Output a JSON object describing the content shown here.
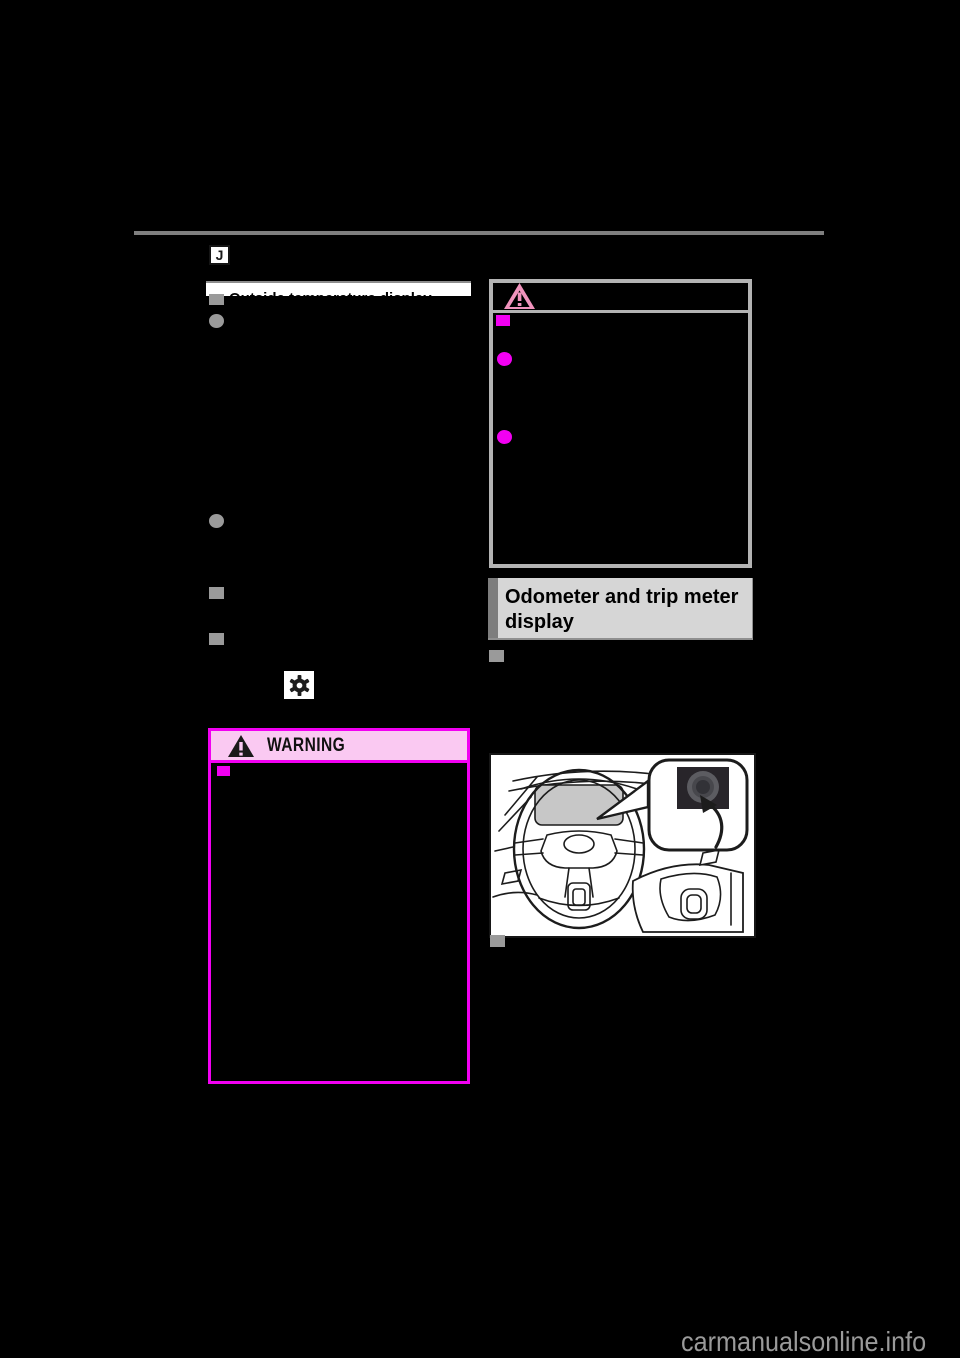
{
  "page": {
    "section_tab_label": "J",
    "watermark_text": "carmanualsonline.info"
  },
  "left_column": {
    "section_heading": "Outside temperature display",
    "bullet_markers": [
      "square",
      "circle",
      "circle",
      "square",
      "square"
    ],
    "inline_icon": "gear-icon",
    "warning_box": {
      "title": "WARNING",
      "icon": "warning-triangle-icon",
      "bullet_markers": [
        "square"
      ]
    }
  },
  "right_column": {
    "notice_box": {
      "icon": "notice-triangle-icon",
      "bullet_markers": [
        "square",
        "circle",
        "circle"
      ]
    },
    "section_heading_lines": [
      "Odometer and trip meter",
      "display"
    ],
    "bullet_below_heading": "square",
    "illustration": {
      "description": "Dashboard line drawing with steering wheel, instrument cluster and callout of the trip meter reset knob",
      "callout_icon": "trip-reset-knob-icon"
    },
    "bullet_below_illustration": "square"
  },
  "colors": {
    "page_background": "#000000",
    "magenta_accent": "#f200f2",
    "warning_header_pink": "#fac9f2",
    "notice_triangle_pink": "#f193bd",
    "gray_bullet": "#9a9a9a",
    "heading_box_gray": "#d6d6d6",
    "heading_box_bar_gray": "#7d7d7d",
    "top_rule_gray": "#7f7f7f",
    "watermark_gray": "#9a9a9a",
    "cluster_gray": "#c7c7c7"
  }
}
